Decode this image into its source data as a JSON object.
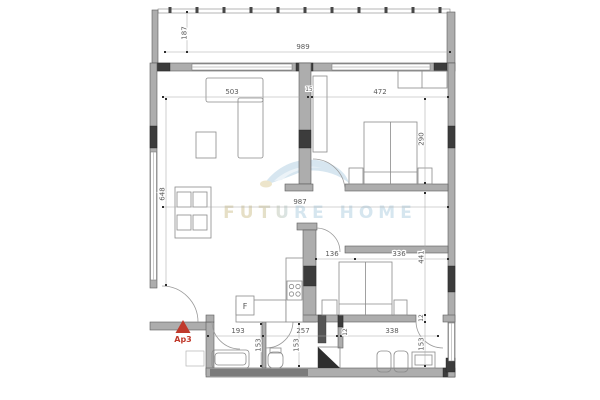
{
  "watermark": {
    "brand": "FUTURE HOME"
  },
  "unit": {
    "label": "Ap3"
  },
  "kitchen": {
    "fridge_label": "F"
  },
  "dims": {
    "balcony_w": "989",
    "balcony_d": "187",
    "living_w": "503",
    "wall15": "15",
    "bed1_w": "472",
    "bed1_d": "290",
    "total_w": "987",
    "living_h": "648",
    "nook": "136",
    "bed2_w": "336",
    "right_d": "441",
    "wall12_right": "12",
    "bath1_w": "193",
    "bath2_w": "257",
    "wall12_mid": "12",
    "bath3_w": "338",
    "bath1_d": "153",
    "bath2_d": "153",
    "bath3_d": "153"
  }
}
